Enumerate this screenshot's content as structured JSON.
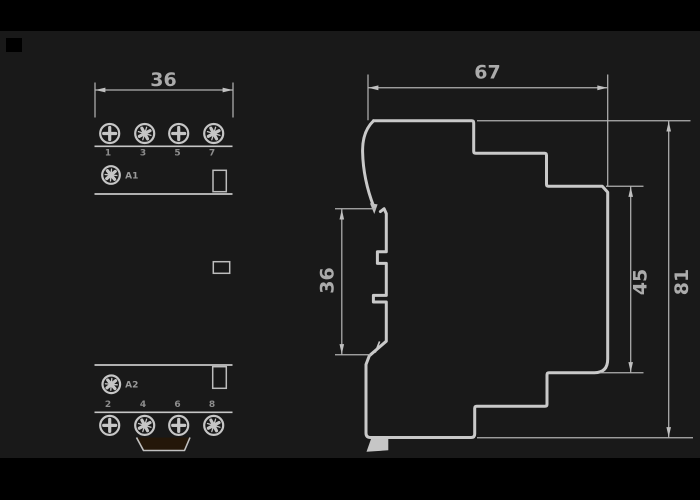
{
  "drawing": {
    "type": "dimension-drawing",
    "front_view": {
      "width_dimension": "36",
      "terminal_numbers_top": [
        "1",
        "3",
        "5",
        "7"
      ],
      "terminal_numbers_bottom": [
        "2",
        "4",
        "6",
        "8"
      ],
      "coil_terminal_top": "A1",
      "coil_terminal_bottom": "A2"
    },
    "side_view": {
      "depth_dimension": "67",
      "overall_height_dimension": "81",
      "body_height_dimension": "45",
      "rail_section_dimension": "36"
    },
    "icons": {
      "phillips_screw": "+",
      "pozidriv_screw": "+ with angled tick marks"
    },
    "colors": {
      "background": "#191919",
      "margin_band": "#000000",
      "line": "#c9c9c9",
      "dim_text": "#ababab",
      "terminal_text": "#8d8d8d",
      "clip_fill": "#241709"
    }
  }
}
